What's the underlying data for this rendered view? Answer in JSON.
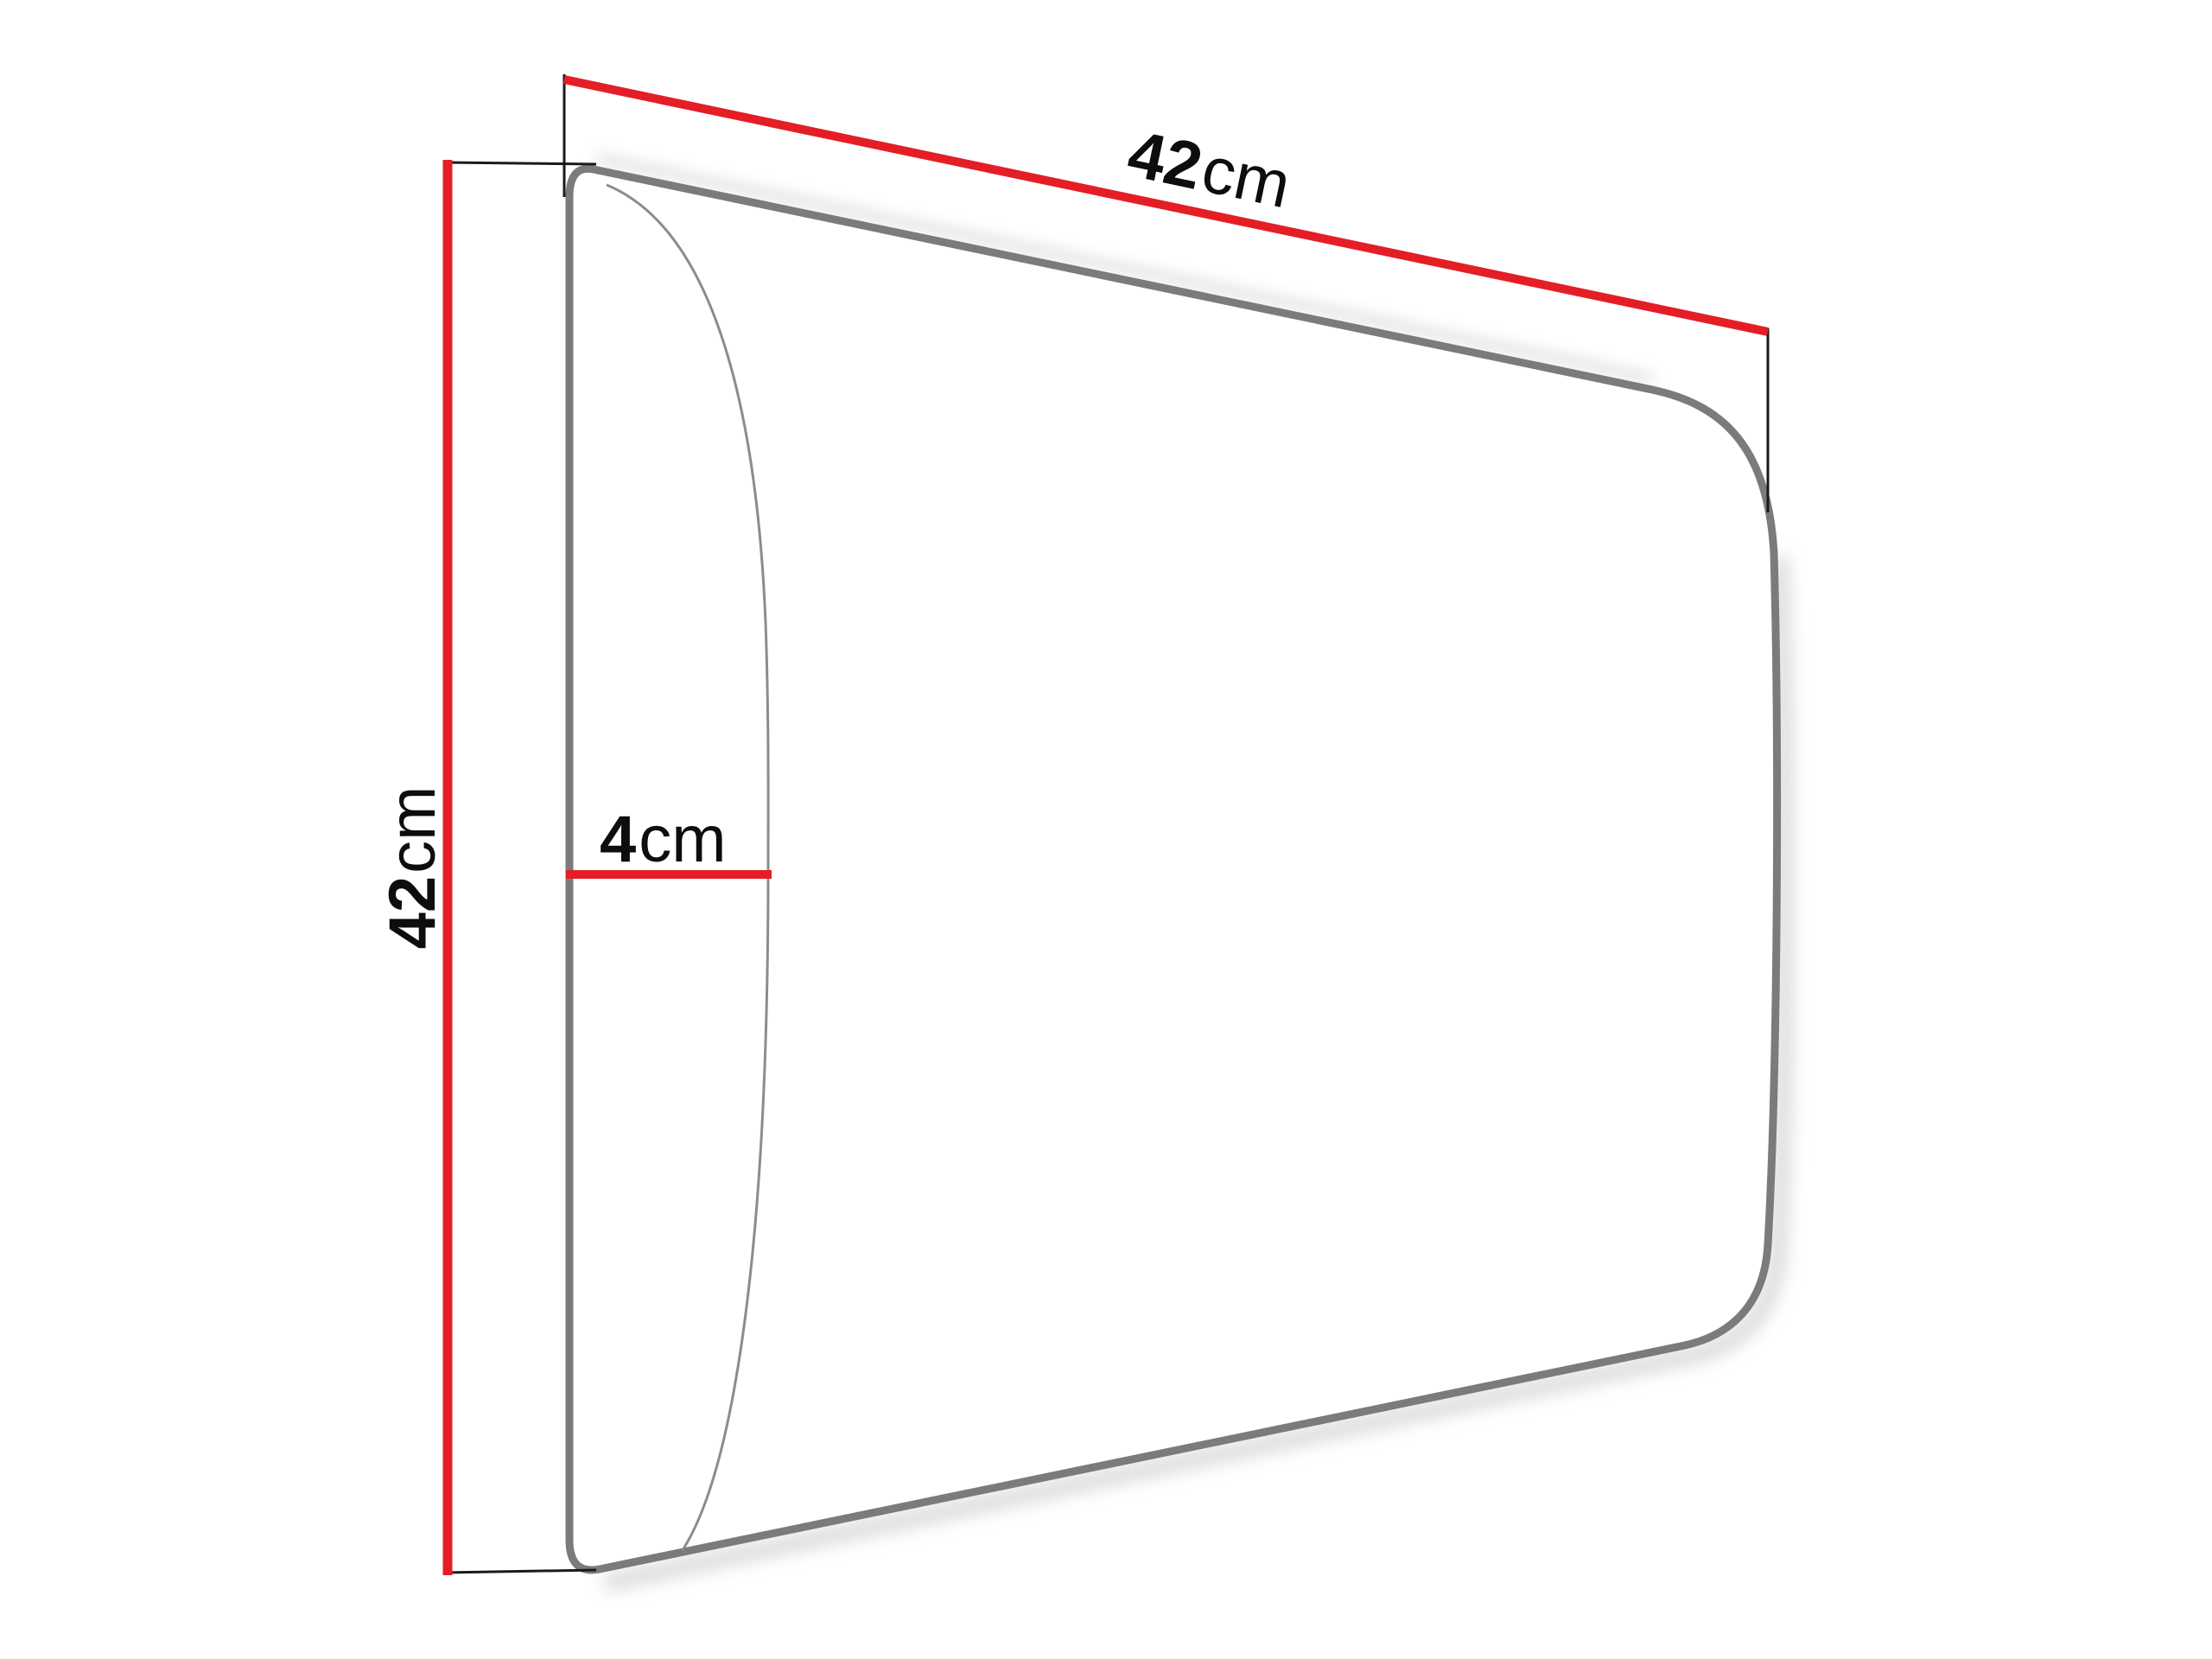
{
  "diagram": {
    "name": "upholstered-panel-dimension-diagram",
    "width_label": {
      "value": "42",
      "unit": "cm"
    },
    "height_label": {
      "value": "42",
      "unit": "cm"
    },
    "depth_label": {
      "value": "4",
      "unit": "cm"
    }
  },
  "colors": {
    "background": "#ffffff",
    "dimension_line_red": "#e41e26",
    "panel_outline_gray": "#7b7b7b",
    "bulge_line_gray": "#8c8c8c",
    "extension_line_black": "#1a1a1a",
    "label_text_black": "#0d0d0d",
    "shadow_gray": "#aaaaaa"
  }
}
